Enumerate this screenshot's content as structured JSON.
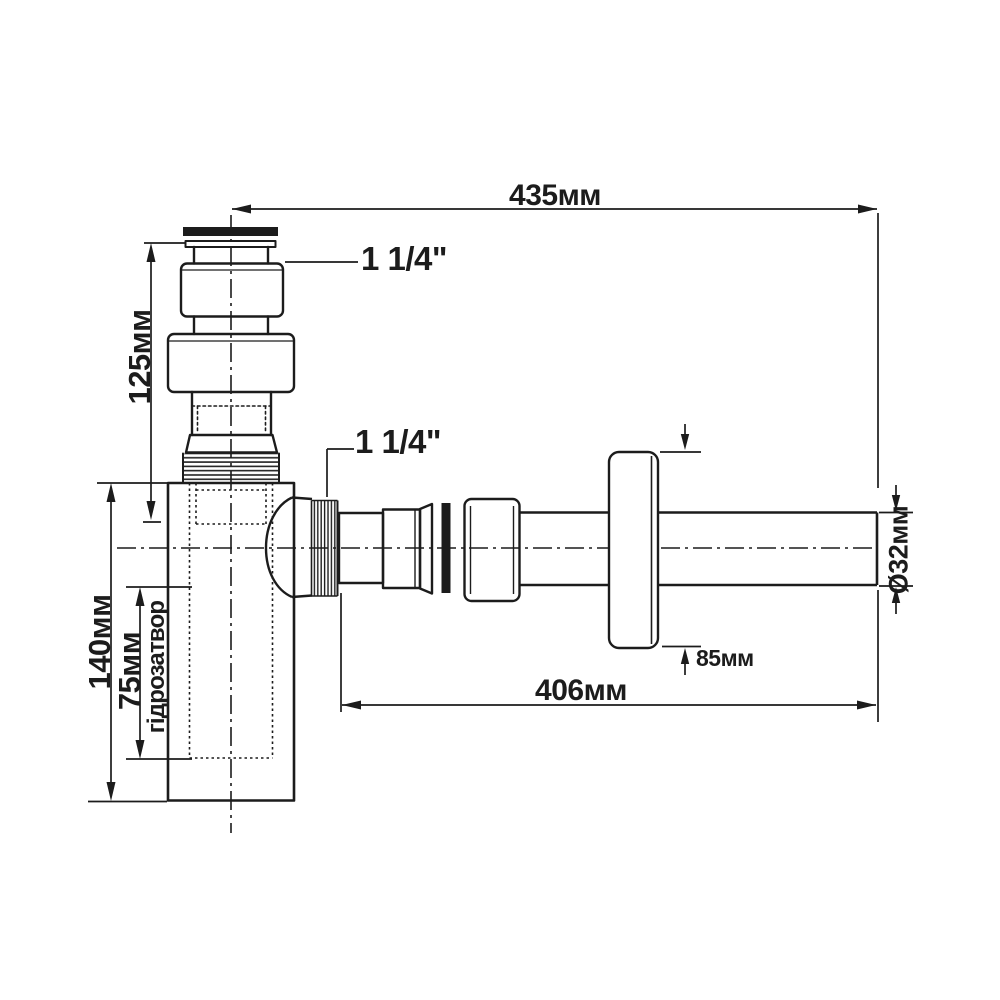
{
  "title": "Bottle trap (siphon) technical drawing",
  "colors": {
    "line": "#1c1c1c",
    "background": "#ffffff"
  },
  "labels": {
    "dim_top_width": "435мм",
    "dim_bottom_width": "406мм",
    "dim_inlet_height": "125мм",
    "dim_body_height": "140мм",
    "dim_water_seal": "75мм",
    "water_seal_caption": "гідрозатвор",
    "dim_flange_offset": "85мм",
    "dim_pipe_diameter": "Ø32мм",
    "inlet_thread_size": "1 1/4\"",
    "outlet_thread_size": "1 1/4\""
  }
}
